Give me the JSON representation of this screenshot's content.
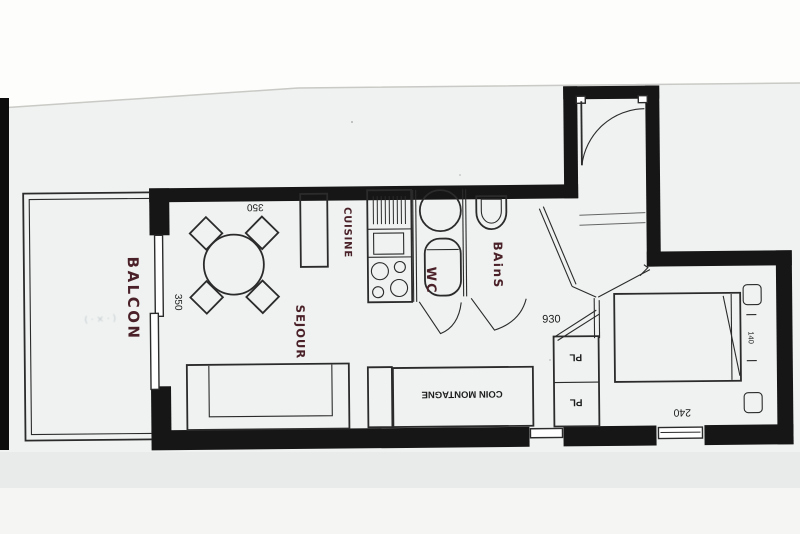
{
  "plan": {
    "labels": {
      "balcon": "BALCON",
      "sejour": "SEJOUR",
      "cuisine": "CUISINE",
      "wc": "WC",
      "bains": "BAinS",
      "coin_montagne": "COIN MONTAGNE",
      "placard_top": "PL",
      "placard_bottom": "PL"
    },
    "dimensions": {
      "sejour_width_top": "350",
      "sejour_window": "350",
      "hall_length": "930",
      "bedroom_width": "240",
      "bed_width": "140"
    },
    "faint_note": "( · × · )",
    "colors": {
      "wall": "#161616",
      "handwriting": "#4b2129",
      "paper": "#eff2f0",
      "line": "#2b2b2b"
    }
  }
}
